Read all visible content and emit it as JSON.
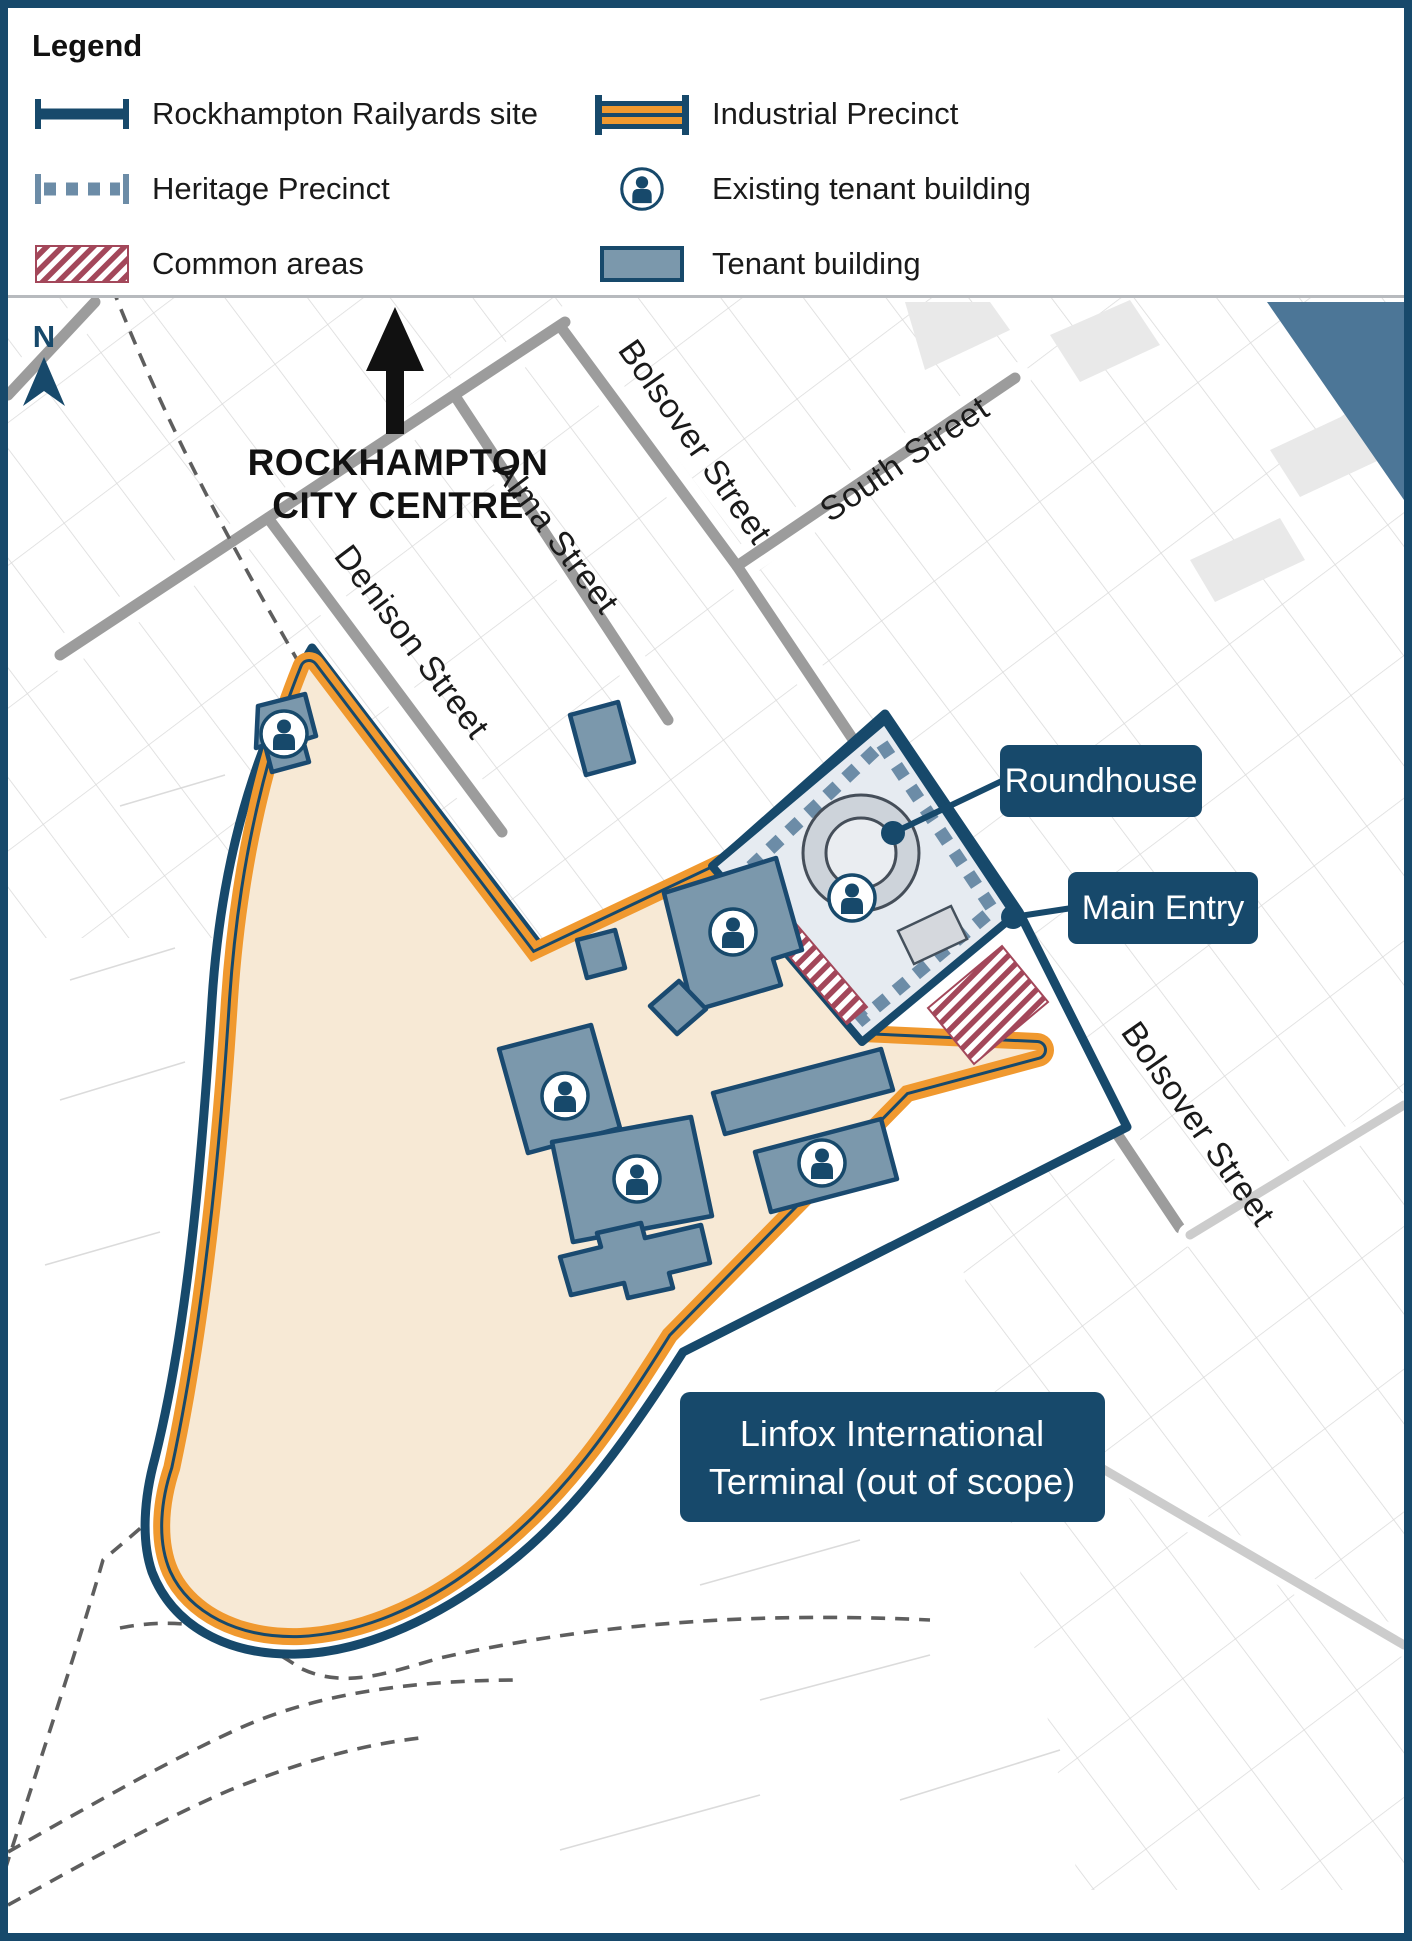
{
  "legend": {
    "title": "Legend",
    "items": [
      {
        "id": "railyards-site",
        "label": "Rockhampton Railyards site"
      },
      {
        "id": "heritage-precinct",
        "label": "Heritage Precinct"
      },
      {
        "id": "common-areas",
        "label": "Common areas"
      },
      {
        "id": "industrial-precinct",
        "label": "Industrial Precinct"
      },
      {
        "id": "existing-tenant",
        "label": "Existing tenant building"
      },
      {
        "id": "tenant-building",
        "label": "Tenant building"
      }
    ]
  },
  "map": {
    "north": "N",
    "city_centre_line1": "ROCKHAMPTON",
    "city_centre_line2": "CITY CENTRE",
    "streets": {
      "denison": "Denison Street",
      "alma": "Alma Street",
      "bolsover_top": "Bolsover Street",
      "south": "South Street",
      "bolsover_right": "Bolsover Street"
    },
    "callouts": {
      "roundhouse": "Roundhouse",
      "main_entry": "Main Entry",
      "linfox_line1": "Linfox International",
      "linfox_line2": "Terminal (out of scope)"
    }
  },
  "colors": {
    "navy": "#17496B",
    "orange": "#F0992F",
    "building_fill": "#7B98AC",
    "building_border": "#1A4A70",
    "heritage_dash": "#6C8CA7",
    "heritage_fill": "#E6EBF1",
    "site_fill": "#F7E9D5",
    "common_hatch": "#A3475A",
    "river": "#4C7697",
    "street": "#9C9C9C",
    "rail_dash": "#5E5E5E"
  }
}
